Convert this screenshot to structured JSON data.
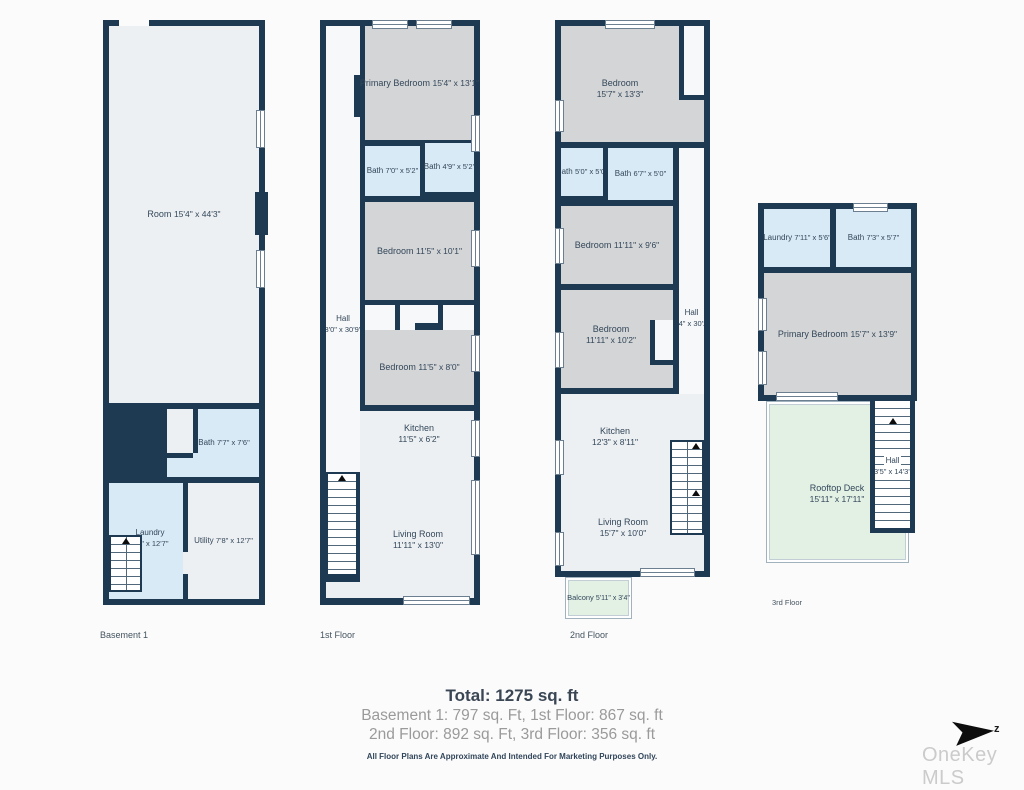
{
  "colors": {
    "wall": "#1e3a52",
    "room_gray": "#d4d5d6",
    "room_light": "#edf0f2",
    "bath_blue": "#d8eaf6",
    "deck_green": "#e3f1e5",
    "background": "#fbfbfb"
  },
  "floors": [
    {
      "label": "Basement 1",
      "rooms": [
        {
          "name": "Room",
          "dims": "15'4\" x 44'3\""
        },
        {
          "name": "Bath",
          "dims": "7'7\" x 7'6\""
        },
        {
          "name": "Laundry",
          "dims": "7'4\" x 12'7\""
        },
        {
          "name": "Utility",
          "dims": "7'8\" x 12'7\""
        }
      ]
    },
    {
      "label": "1st Floor",
      "rooms": [
        {
          "name": "Primary Bedroom",
          "dims": "15'4\" x 13'1\""
        },
        {
          "name": "Bath",
          "dims": "7'0\" x 5'2\""
        },
        {
          "name": "Bath",
          "dims": "4'9\" x 5'2\""
        },
        {
          "name": "Bedroom",
          "dims": "11'5\" x 10'1\""
        },
        {
          "name": "Hall",
          "dims": "3'0\" x 30'9\""
        },
        {
          "name": "Bedroom",
          "dims": "11'5\" x 8'0\""
        },
        {
          "name": "Kitchen",
          "dims": "11'5\" x 6'2\""
        },
        {
          "name": "Living Room",
          "dims": "11'11\" x 13'0\""
        }
      ]
    },
    {
      "label": "2nd Floor",
      "rooms": [
        {
          "name": "Bedroom",
          "dims": "15'7\" x 13'3\""
        },
        {
          "name": "Bath",
          "dims": "5'0\" x 5'0\""
        },
        {
          "name": "Bath",
          "dims": "6'7\" x 5'0\""
        },
        {
          "name": "Bedroom",
          "dims": "11'11\" x 9'6\""
        },
        {
          "name": "Hall",
          "dims": "3'4\" x 30'2\""
        },
        {
          "name": "Bedroom",
          "dims": "11'11\" x 10'2\""
        },
        {
          "name": "Kitchen",
          "dims": "12'3\" x 8'11\""
        },
        {
          "name": "Living Room",
          "dims": "15'7\" x 10'0\""
        },
        {
          "name": "Balcony",
          "dims": "5'11\" x 3'4\""
        }
      ]
    },
    {
      "label": "3rd Floor",
      "rooms": [
        {
          "name": "Laundry",
          "dims": "7'11\" x 5'6\""
        },
        {
          "name": "Bath",
          "dims": "7'3\" x 5'7\""
        },
        {
          "name": "Primary Bedroom",
          "dims": "15'7\" x 13'9\""
        },
        {
          "name": "Rooftop Deck",
          "dims": "15'11\" x 17'11\""
        },
        {
          "name": "Hall",
          "dims": "3'5\" x 14'3\""
        }
      ]
    }
  ],
  "summary": {
    "total": "Total: 1275 sq. ft",
    "line1": "Basement 1: 797 sq. Ft, 1st Floor: 867 sq. ft",
    "line2": "2nd Floor: 892 sq. Ft,  3rd Floor: 356 sq. ft",
    "disclaimer": "All Floor Plans Are Approximate And Intended For Marketing Purposes Only."
  },
  "compass": {
    "label": "z"
  },
  "watermark": "OneKey MLS"
}
